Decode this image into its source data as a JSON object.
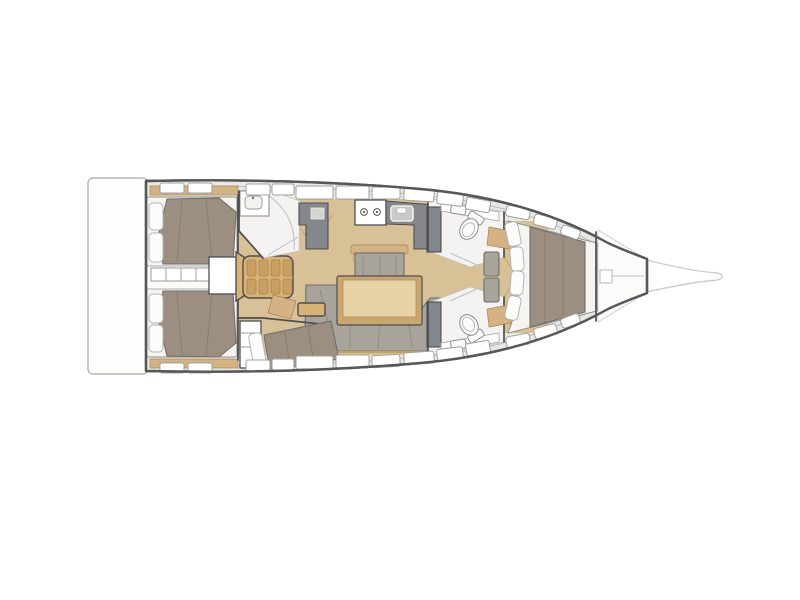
{
  "diagram": {
    "kind": "sailing-yacht-interior-floor-plan",
    "view": "top-down",
    "orientation": "bow-right-stern-left",
    "background_color": "#ffffff"
  },
  "palette": {
    "hull_outline": "#57575a",
    "platform_outline": "#b7b7b5",
    "bowsprit_outline": "#cccccb",
    "deck_band": "#e8e8e5",
    "room_floor": "#f4f3f1",
    "wood_floor": "#d8c197",
    "wood_trim": "#d3b284",
    "wood_edge": "#a8854f",
    "steps": "#d9b278",
    "tread": "#c9a062",
    "mattress": "#f5f4f1",
    "bed": "#9c8e81",
    "bed_outline": "#6f6e6b",
    "pillow": "#fcfcfb",
    "pillow_outline": "#b3b3b0",
    "sofa": "#a9a49b",
    "counter": "#84878b",
    "wall": "#4e4e50",
    "fixture": "#fbfbf9",
    "fixture_outline": "#8e8e8c",
    "window_border": "#a0a09e",
    "thin_line": "#bdbdbb",
    "floor_line": "#c2a878",
    "table_frame": "#caa76f",
    "table_top": "#e6d2a4",
    "sink_fill": "#c9c9c7"
  },
  "semantic_regions": [
    {
      "id": "swim-platform"
    },
    {
      "id": "aft-cabin-port"
    },
    {
      "id": "aft-cabin-starboard"
    },
    {
      "id": "aft-passage"
    },
    {
      "id": "companionway-steps"
    },
    {
      "id": "aft-head"
    },
    {
      "id": "galley"
    },
    {
      "id": "salon"
    },
    {
      "id": "salon-table"
    },
    {
      "id": "mid-cabin-starboard"
    },
    {
      "id": "forward-head-port"
    },
    {
      "id": "forward-head-starboard"
    },
    {
      "id": "forward-cabin"
    },
    {
      "id": "anchor-locker"
    },
    {
      "id": "bowsprit"
    }
  ]
}
